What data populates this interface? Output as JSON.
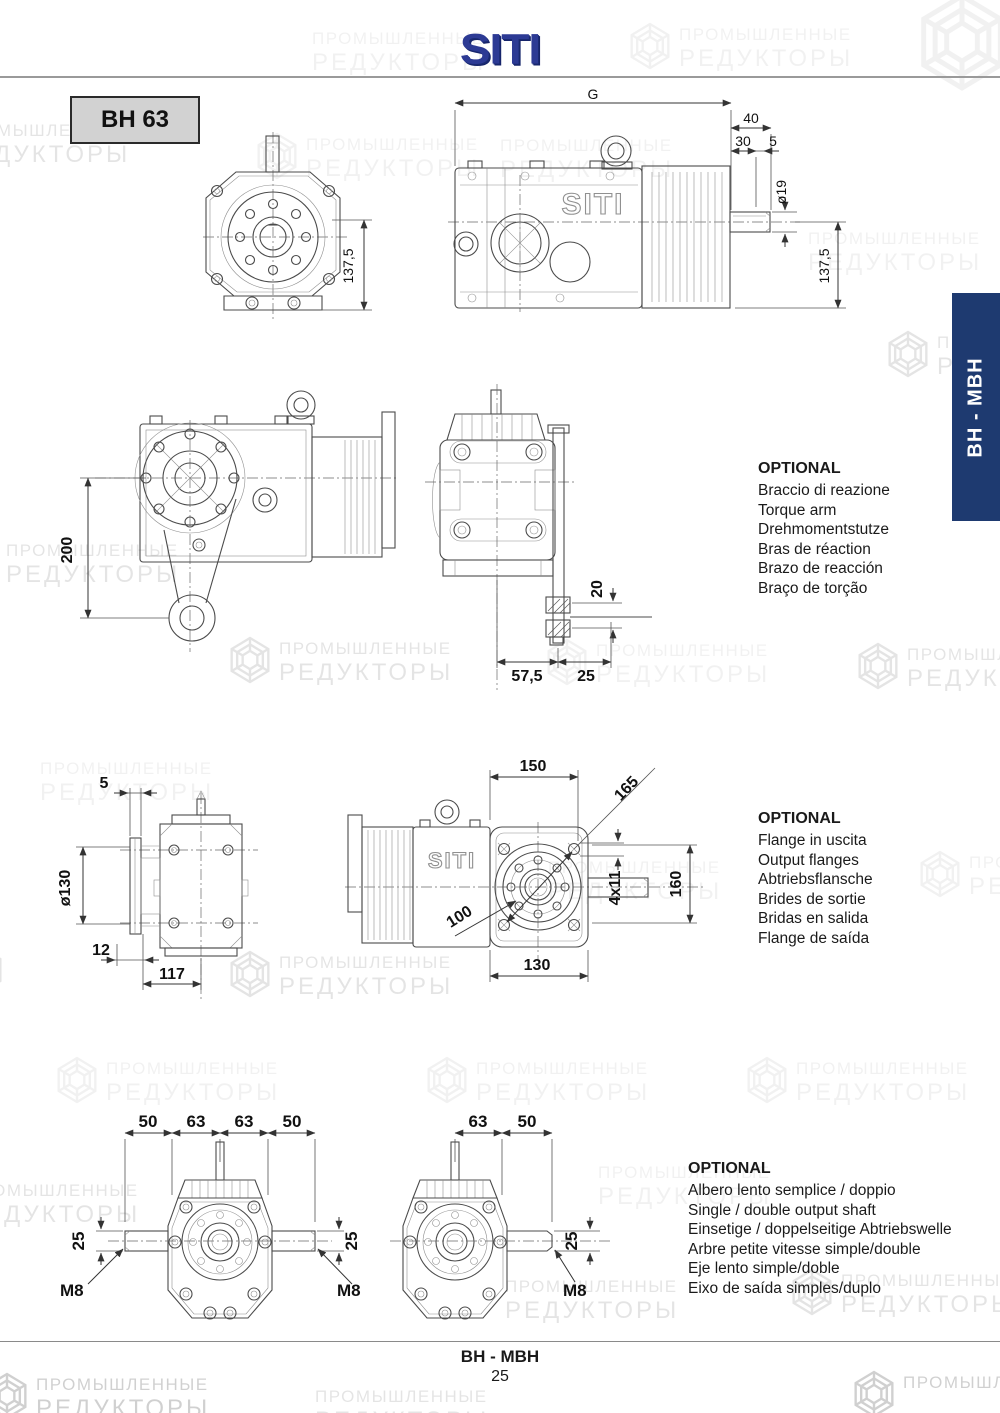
{
  "header": {
    "logo": "SITI",
    "model": "BH 63"
  },
  "side_tab": {
    "label": "BH - MBH",
    "color": "#1e3a70"
  },
  "watermark": {
    "line1": "ПРОМЫШЛЕННЫЕ",
    "line2": "РЕДУКТОРЫ"
  },
  "footer": {
    "series": "BH - MBH",
    "page_number": "25"
  },
  "optional_blocks": [
    {
      "title": "OPTIONAL",
      "lines": [
        "Braccio di reazione",
        "Torque arm",
        "Drehmomentstutze",
        "Bras de réaction",
        "Brazo de reacción",
        "Braço de torção"
      ]
    },
    {
      "title": "OPTIONAL",
      "lines": [
        "Flange in uscita",
        "Output flanges",
        "Abtriebsflansche",
        "Brides de sortie",
        "Bridas en salida",
        "Flange de saída"
      ]
    },
    {
      "title": "OPTIONAL",
      "lines": [
        "Albero lento semplice / doppio",
        "Single / double output shaft",
        "Einsetige / doppelseitige Abtriebswelle",
        "Arbre petite vitesse simple/double",
        "Eje lento simple/doble",
        "Eixo de saída simples/duplo"
      ]
    }
  ],
  "drawings": {
    "cast_logo": "SITI",
    "front_view": {
      "dim_height": "137,5"
    },
    "side_view": {
      "dim_g": "G",
      "dim_40": "40",
      "dim_30": "30",
      "dim_5": "5",
      "dim_shaft_dia": "ø19",
      "dim_height": "137,5"
    },
    "torque_arm_side": {
      "dim_length": "200"
    },
    "torque_arm_end": {
      "dim_bush": "20",
      "dim_offset": "57,5",
      "dim_bush_len": "25"
    },
    "flange_end": {
      "dim_plate": "5",
      "dim_flange_dia": "ø130",
      "dim_offset": "12",
      "dim_depth": "117"
    },
    "flange_face": {
      "dim_width_top": "150",
      "dim_diag": "165",
      "dim_holes": "4x11",
      "dim_height": "160",
      "dim_bolt_circle": "100",
      "dim_width_bottom": "130"
    },
    "double_shaft": {
      "dim_a": "50",
      "dim_b": "63",
      "dim_c": "63",
      "dim_d": "50",
      "dim_shaft_l": "25",
      "dim_shaft_r": "25",
      "thread_l": "M8",
      "thread_r": "M8"
    },
    "single_shaft": {
      "dim_a": "63",
      "dim_b": "50",
      "dim_shaft": "25",
      "thread": "M8"
    }
  }
}
